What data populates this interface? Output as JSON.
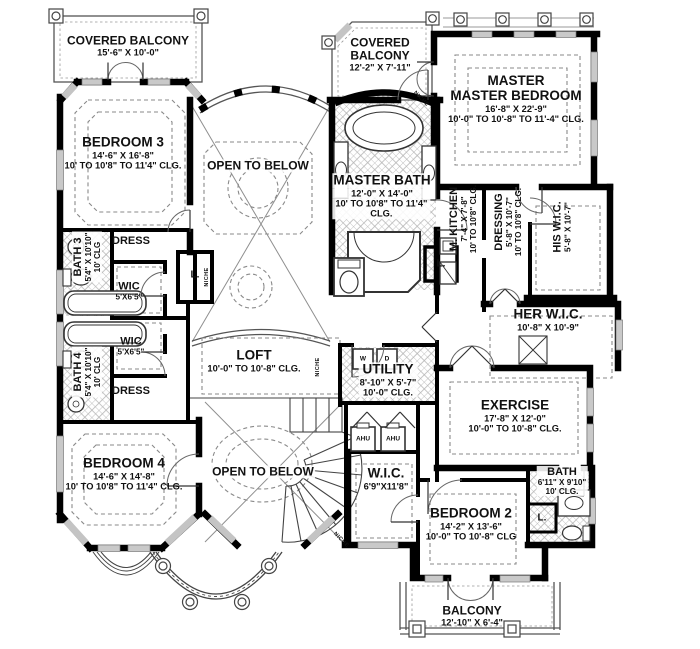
{
  "rooms": {
    "covered_balcony_left": {
      "name": "COVERED BALCONY",
      "dims": "15'-6\" X 10'-0\""
    },
    "covered_balcony_mid": {
      "line1": "COVERED",
      "line2": "BALCONY",
      "dims": "12'-2\" X 7'-11\""
    },
    "master_bedroom": {
      "line1": "MASTER",
      "line2": "MASTER BEDROOM",
      "dims": "16'-8\" X 22'-9\"",
      "clg": "10'-0\" TO 10'-8\" TO 11'-4\" CLG."
    },
    "bedroom3": {
      "name": "BEDROOM 3",
      "dims": "14'-6\" X 16'-8\"",
      "clg": "10' TO 10'8\" TO 11'4\" CLG."
    },
    "open_below_top": {
      "name": "OPEN TO BELOW"
    },
    "master_bath": {
      "name": "MASTER BATH",
      "dims": "12'-0\" X 14'-0\"",
      "clg": "10' TO 10'8\" TO 11'4\" CLG."
    },
    "m_kitchen": {
      "name": "M. KITCHEN",
      "dims": "7'-4\" X 7'-8\"",
      "clg": "10' TO 10'8\" CLG."
    },
    "dressing": {
      "name": "DRESSING",
      "dims": "5'-8\" X 10'-7\"",
      "clg": "10' TO 10'8\" CLG."
    },
    "his_wic": {
      "name": "HIS W.I.C.",
      "dims": "5'-8\" X 10'-7\""
    },
    "her_wic": {
      "name": "HER W.I.C.",
      "dims": "10'-8\" X 10'-9\""
    },
    "bath3": {
      "name": "BATH 3",
      "dims": "5'4\" X 10'10\"",
      "clg": "10' CLG"
    },
    "bath4": {
      "name": "BATH 4",
      "dims": "5'4\" X 10'10\"",
      "clg": "10' CLG"
    },
    "dress": {
      "name": "DRESS"
    },
    "wic_small": {
      "name": "WIC",
      "dims": "5'X6'5\""
    },
    "loft": {
      "name": "LOFT",
      "clg": "10'-0\" TO 10'-8\" CLG."
    },
    "utility": {
      "name": "UTILITY",
      "dims": "8'-10\" X 5'-7\"",
      "clg": "10'-0\" CLG."
    },
    "bedroom4": {
      "name": "BEDROOM 4",
      "dims": "14'-6\" X 14'-8\"",
      "clg": "10' TO 10'8\" TO 11'4\" CLG."
    },
    "open_below_bottom": {
      "name": "OPEN TO BELOW"
    },
    "exercise": {
      "name": "EXERCISE",
      "dims": "17'-8\" X 12'-0\"",
      "clg": "10'-0\" TO 10'-8\" CLG."
    },
    "wic_bedroom2": {
      "name": "W.I.C.",
      "dims": "6'9\"X11'8\""
    },
    "bedroom2": {
      "name": "BEDROOM 2",
      "dims": "14'-2\" X 13'-6\"",
      "clg": "10'-0\" TO 10'-8\" CLG"
    },
    "bath2": {
      "name": "BATH",
      "dims": "6'11\" X 9'10\"",
      "clg": "10' CLG."
    },
    "balcony": {
      "name": "BALCONY",
      "dims": "12'-10\" X 6'-4\""
    }
  },
  "fixtures": {
    "ahu": "AHU",
    "washer": "W",
    "dryer": "D",
    "linen": "L.",
    "niche": "NICHE"
  },
  "colors": {
    "wall": "#000000",
    "line": "#444444",
    "dashed": "#8a8a8a",
    "window": "#c9c9c9",
    "hatch": "#ababab",
    "text": "#111111",
    "background": "#ffffff"
  }
}
